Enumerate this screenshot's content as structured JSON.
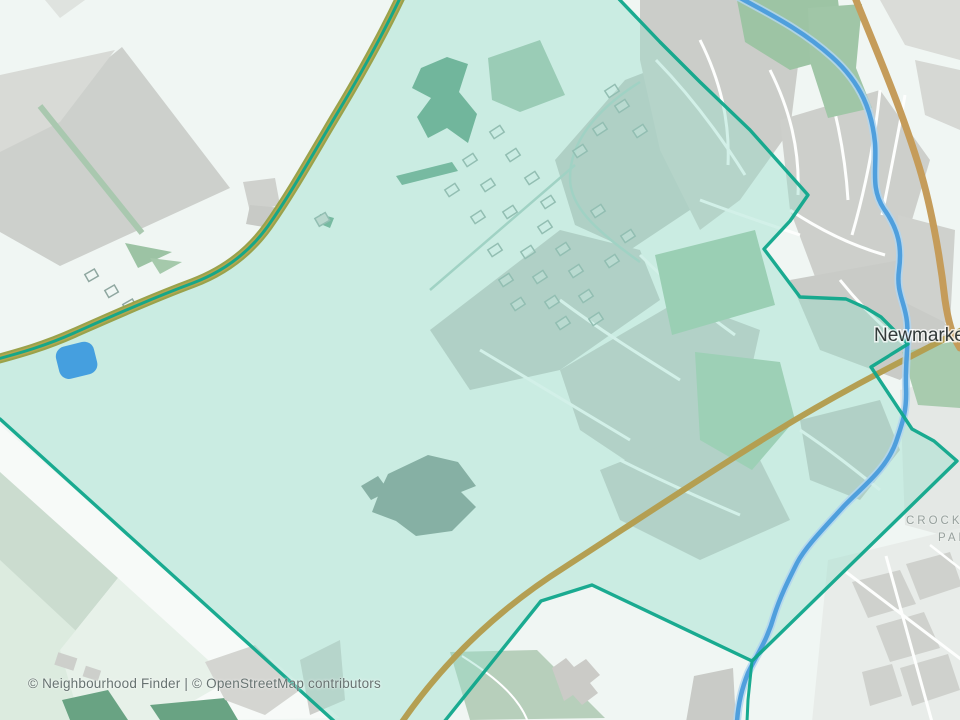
{
  "map": {
    "labels": {
      "town": "Newmarket",
      "district_line1": "CROCKFORD",
      "district_line2": "PARK"
    },
    "attribution": "© Neighbourhood Finder | © OpenStreetMap contributors",
    "colors": {
      "background": "#f0f6f3",
      "highlight_fill": "rgba(150,222,202,0.42)",
      "boundary_stroke": "#0fa78b",
      "road_primary": "#c59c5a",
      "road_secondary": "#b49f52",
      "road_nw_casing": "#9aa24b",
      "road_nw_inner": "#b3a74f",
      "river_core": "#4f9fdd",
      "river_halo": "#b3d6ef",
      "pond_fill": "#459fdf",
      "park_green": "#9dc4a4",
      "dark_green": "#56997a",
      "urban_gray": "#cbcdc9",
      "field_gray": "#cdd0cc"
    }
  }
}
